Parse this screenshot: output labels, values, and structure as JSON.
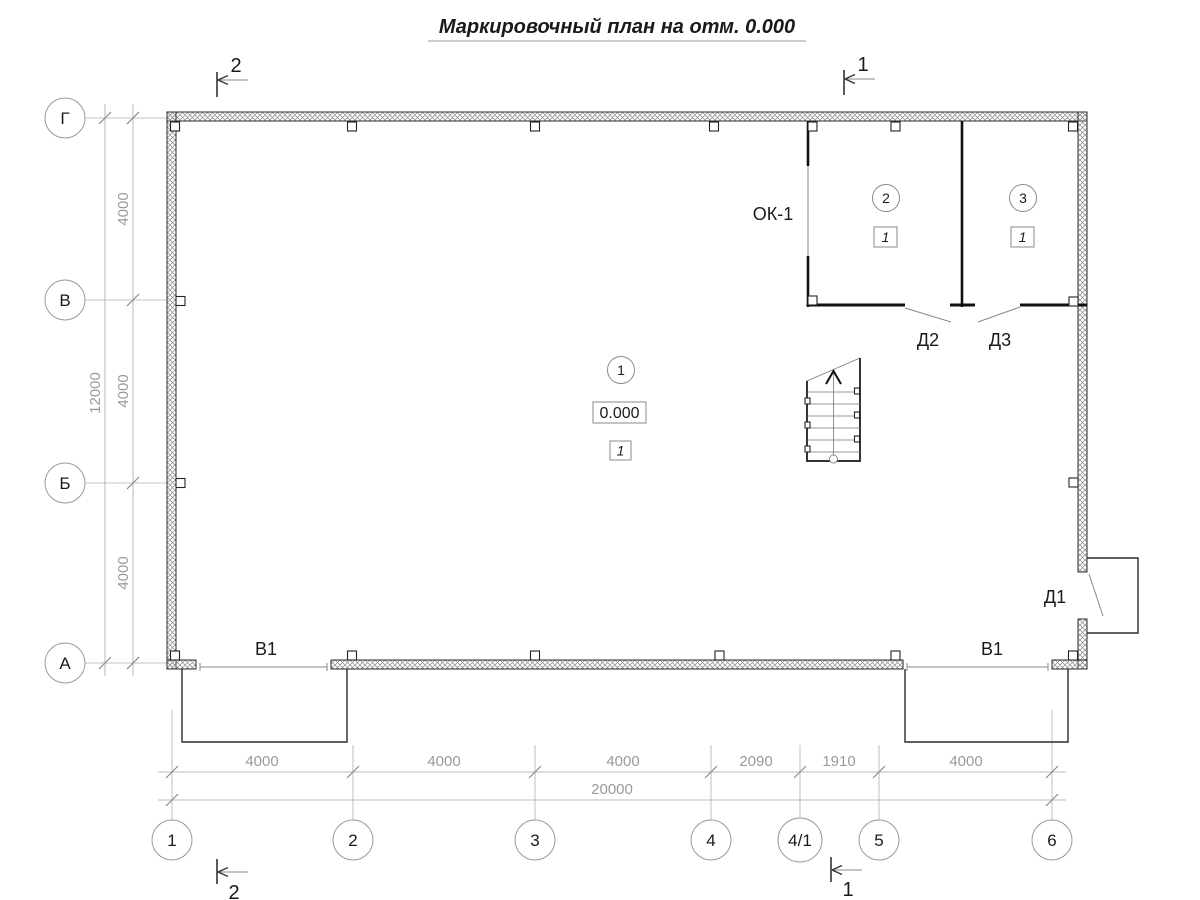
{
  "title": "Маркировочный план на отм. 0.000",
  "grid": {
    "vertical_axes": [
      "Г",
      "В",
      "Б",
      "А"
    ],
    "horizontal_axes": [
      "1",
      "2",
      "3",
      "4",
      "4/1",
      "5",
      "6"
    ]
  },
  "dimensions": {
    "left": {
      "segments": [
        "4000",
        "4000",
        "4000"
      ],
      "total": "12000"
    },
    "bottom": {
      "segments": [
        "4000",
        "4000",
        "4000",
        "2090",
        "1910",
        "4000"
      ],
      "total": "20000"
    }
  },
  "section_marks": {
    "top_left": "2",
    "top_right": "1",
    "bottom_left": "2",
    "bottom_right": "1"
  },
  "rooms": [
    {
      "number": "1",
      "elevation": "0.000",
      "finish_type": "1"
    },
    {
      "number": "2",
      "finish_type": "1"
    },
    {
      "number": "3",
      "finish_type": "1"
    }
  ],
  "openings": {
    "window_label": "ОК-1",
    "door_d1": "Д1",
    "door_d2": "Д2",
    "door_d3": "Д3",
    "gate_left": "В1",
    "gate_right": "В1"
  },
  "colors": {
    "line": "#1a1a1a",
    "dimension": "#9a9a9a",
    "hatch": "#8a8a8a",
    "background": "#ffffff"
  }
}
